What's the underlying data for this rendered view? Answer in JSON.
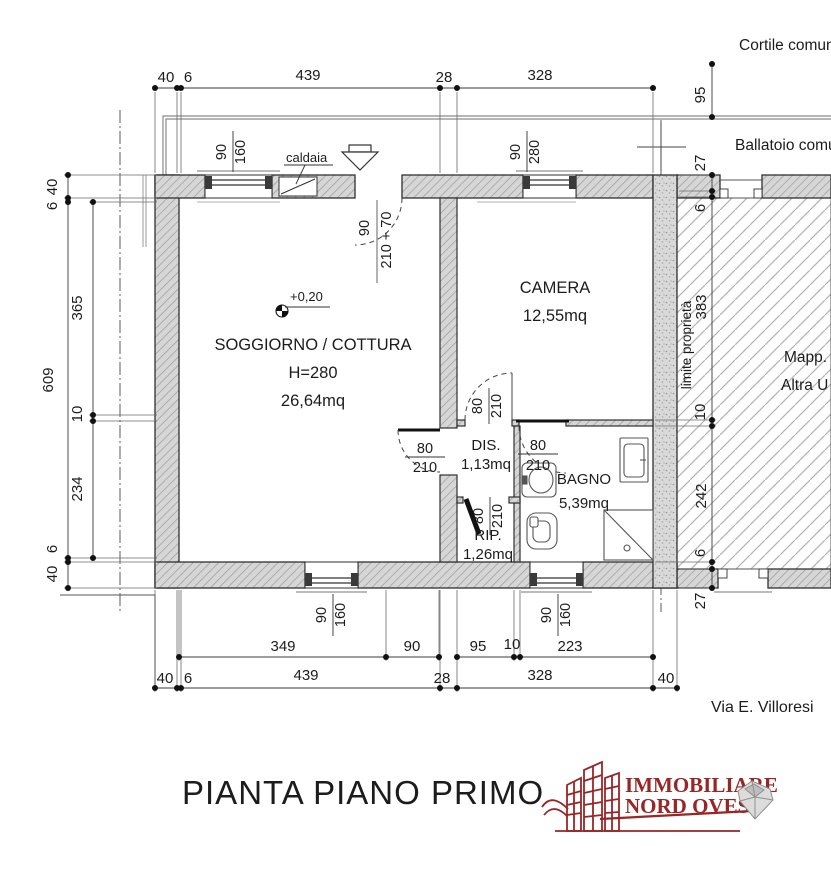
{
  "plan": {
    "title": "PIANTA PIANO PRIMO",
    "street": "Via E. Villoresi",
    "context": {
      "courtyard": "Cortile comune",
      "balcony": "Ballatoio comune",
      "property_limit": "limite proprietà",
      "map_label": "Mapp.",
      "other_unit": "Altra U"
    },
    "rooms": {
      "soggiorno": {
        "name": "SOGGIORNO / COTTURA",
        "height": "H=280",
        "area": "26,64mq"
      },
      "camera": {
        "name": "CAMERA",
        "area": "12,55mq"
      },
      "dis": {
        "name": "DIS.",
        "area": "1,13mq"
      },
      "bagno": {
        "name": "BAGNO",
        "area": "5,39mq"
      },
      "rip": {
        "name": "RIP.",
        "area": "1,26mq"
      }
    },
    "annotations": {
      "caldaia": "caldaia",
      "level": "+0,20"
    },
    "dims": {
      "d40": "40",
      "d6": "6",
      "d439": "439",
      "d28": "28",
      "d328": "328",
      "d95": "95",
      "d27": "27",
      "d383": "383",
      "d10": "10",
      "d242": "242",
      "d365": "365",
      "d234": "234",
      "d609": "609",
      "d349": "349",
      "d90": "90",
      "d160": "160",
      "d280": "280",
      "d80": "80",
      "d210": "210",
      "d223": "223",
      "entry_height": "210 + 70"
    },
    "logo": {
      "line1": "IMMOBILIARE",
      "line2": "NORD OVEST"
    },
    "colors": {
      "accent": "#992626",
      "wall": "#d6d6d6",
      "line": "#2f2f2f"
    }
  }
}
